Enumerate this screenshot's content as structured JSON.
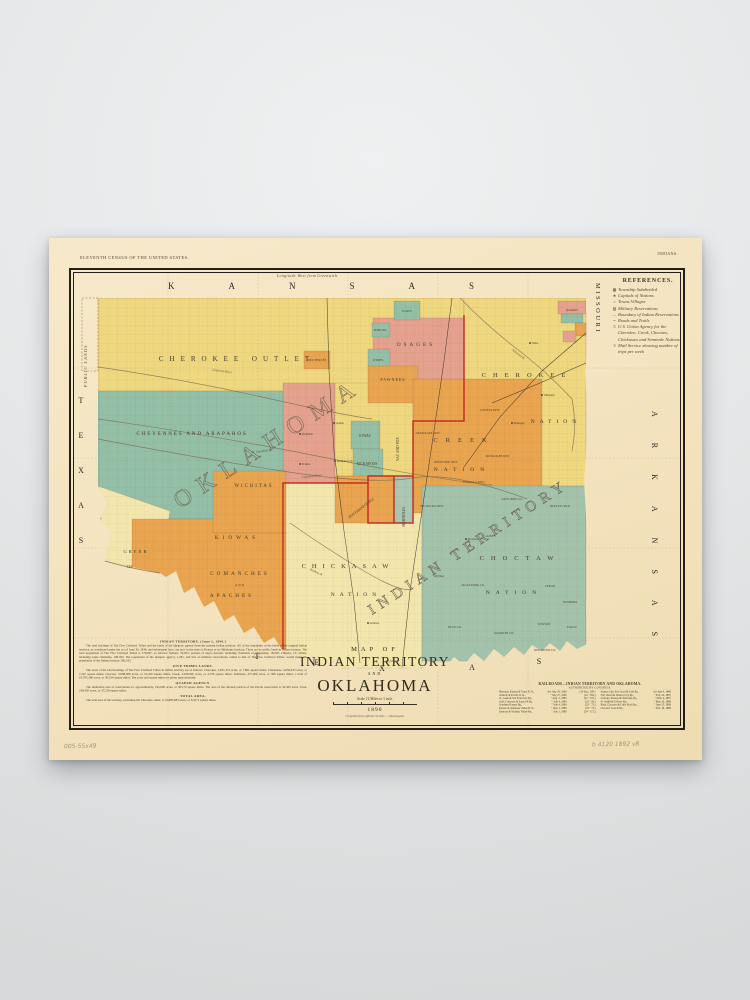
{
  "palette": {
    "paper": "#f3e2bd",
    "yellow": "#eed77f",
    "pale_yellow": "#f1e0a6",
    "pale_yellow2": "#f3e6ad",
    "orange": "#e8a44f",
    "salmon": "#e4a28e",
    "teal": "#94bfa7",
    "teal_light": "#a9c7b2",
    "green": "#a3c2ab",
    "red_line": "#c0251e",
    "ink": "#241f18"
  },
  "poster_notes": {
    "top_left": "ELEVENTH CENSUS OF THE UNITED STATES.",
    "top_right": "INDIANS.",
    "top_center": "Longitude West from Greenwich.",
    "pencil_left": "005-55x49",
    "pencil_right": "b 4120  1892  v8"
  },
  "references": {
    "title": "REFERENCES.",
    "items": [
      {
        "sym": "▦",
        "text": "Township Subdivided"
      },
      {
        "sym": "★",
        "text": "Capitals of Nations"
      },
      {
        "sym": "○",
        "text": "Towns Villages"
      },
      {
        "sym": "▨",
        "text": "Military Reservations"
      },
      {
        "sym": "—",
        "text": "Boundary of Indian Reservations"
      },
      {
        "sym": "=",
        "text": "Roads and Trails"
      },
      {
        "sym": "5",
        "text": "U.S. Union Agency for the Cherokee, Creek, Choctaw, Chickasaw and Seminole Nations"
      },
      {
        "sym": "3",
        "text": "Mail Service showing number of trips per week"
      }
    ]
  },
  "title_block": {
    "line1": "MAP OF",
    "line2": "INDIAN TERRITORY",
    "line3": "AND",
    "line4": "OKLAHOMA",
    "scale_note": "Scale 12 Miles to 1 inch.",
    "year": "1890",
    "imprint": "Compiled from official records — Washington."
  },
  "notes": {
    "sections": [
      {
        "heading": "INDIAN TERRITORY.  (June 1, 1890.)",
        "body": "The land holdings of The Five Civilized Tribes and the lands of the Quapaw agency form the present Indian territory. All of the remainder of the lands of the original Indian territory, as constituted under the act of June 30, 1834, and subsequent laws, are now in the state of Kansas or in Oklahoma territory. There are no public lands in Indian territory. The total population of The Five Civilized Tribes is 178,097, as follows: Indians, 50,055; persons of negro descent, including claimants of citizenship, 18,636; Chinese, 13; whites, including some claimants, 109,393. The population of the Quapaw agency, 1,281, and 941 on military reservations, added to that of The Five Civilized Tribes, would make the population of the Indian territory 180,182."
      },
      {
        "heading": "FIVE TRIBES LANDS.",
        "body": "The areas of the land holdings of The Five Civilized Tribes in Indian territory are as follows: Cherokee, 5,031,351 acres, or 7,861 square miles; Chickasaw, 4,650,935 acres, or 7,267 square miles; Choctaw, 6,688,000 acres, or 10,450 square miles; Creek, 3,040,000 acres, or 4,750 square miles; Seminole, 375,000 acres, or 586 square miles; a total of 19,785,286 acres, or 30,914 square miles. The acres and square miles are given approximately."
      },
      {
        "heading": "QUAPAW AGENCY.",
        "body": "The unallotted area of reservations is, approximately, 195,000 acres, or 305.70 square miles. The area of the allotted portion of the Peoria reservation is 43,450 acres. Total, 238,450 acres, or 372.58 square miles."
      },
      {
        "heading": "TOTAL AREA.",
        "body": "The total area of the territory, excluding the Cherokee outlet, is 19,885,683 acres, or 31,071 square miles."
      }
    ]
  },
  "railroads": {
    "title": "RAILROADS—INDIAN TERRITORY AND OKLAHOMA.",
    "subtitle": "AUTHORIZED BY CONGRESS.",
    "left": [
      {
        "name": "Missouri, Kansas & Texas R. R.,",
        "date": "Act July 26, 1866",
        "cite": "(14 Stat., 289.)"
      },
      {
        "name": "Atlantic & Pacific R. R.,",
        "date": "\"  July 27, 1866",
        "cite": "(14  \"  292.)"
      },
      {
        "name": "St. Louis & San Francisco Ry.,",
        "date": "\"  Aug. 2, 1882",
        "cite": "(22  \"  181.)"
      },
      {
        "name": "Gulf, Colorado & Santa Fé Ry.,",
        "date": "\"  July 4, 1884",
        "cite": "(23  \"  69.)"
      },
      {
        "name": "Southern Kansas Ry.,",
        "date": "\"  July 4, 1884",
        "cite": "(23  \"  73.)"
      },
      {
        "name": "Kansas & Arkansas Valley R. R.,",
        "date": "\"  June 1, 1886",
        "cite": "(24  \"  73.)"
      },
      {
        "name": "Denison & Washita Valley Ry.,",
        "date": "\"  July 1, 1886",
        "cite": "(24  \"  117.)"
      }
    ],
    "right": [
      {
        "name": "Kansas City, Fort Scott & Gulf Ry.,",
        "date": "Act July 4, 1888",
        "cite": "(25 Stat., 236.)"
      },
      {
        "name": "Fort Worth & Denver City Ry.,",
        "date": "\"  Feb. 24, 1887",
        "cite": "(24  \"  446.)"
      },
      {
        "name": "Chicago, Kansas & Nebraska Ry.,",
        "date": "\"  Mch. 2, 1887",
        "cite": "(24  \"  440.)"
      },
      {
        "name": "Ft. Smith & El Paso Ry.,",
        "date": "\"  May 30, 1888",
        "cite": "(25  \"  162.)"
      },
      {
        "name": "Paris, Choctaw & Little Rock Ry.,",
        "date": "\"  June 25, 1888",
        "cite": "(25  \"  205.)"
      },
      {
        "name": "Choctaw Coal & Ry.,",
        "date": "\"  Feb. 18, 1888",
        "cite": "(25  \"  35.)"
      }
    ]
  },
  "map": {
    "labels": [
      {
        "id": "kansas",
        "t": "KANSAS",
        "x": 96,
        "y": 18,
        "s": 9,
        "ls": 54,
        "a": "start",
        "c": "state"
      },
      {
        "id": "missouri",
        "t": "MISSOURI",
        "x": 0,
        "y": 0,
        "s": 6.5,
        "ls": 2.5,
        "a": "start",
        "c": "state",
        "tr": "translate(524,12) rotate(90)"
      },
      {
        "id": "arkansas",
        "t": "ARKANSAS",
        "x": 0,
        "y": 0,
        "s": 8,
        "ls": 26,
        "a": "start",
        "c": "state",
        "tr": "translate(580,140) rotate(90)"
      },
      {
        "id": "texas-w-t",
        "t": "T",
        "x": 9,
        "y": 132,
        "s": 8,
        "c": "state"
      },
      {
        "id": "texas-w-e",
        "t": "E",
        "x": 9,
        "y": 167,
        "s": 8,
        "c": "state"
      },
      {
        "id": "texas-w-x",
        "t": "X",
        "x": 9,
        "y": 202,
        "s": 8,
        "c": "state"
      },
      {
        "id": "texas-w-a",
        "t": "A",
        "x": 9,
        "y": 237,
        "s": 8,
        "c": "state"
      },
      {
        "id": "texas-w-s",
        "t": "S",
        "x": 9,
        "y": 272,
        "s": 8,
        "c": "state"
      },
      {
        "id": "texas-s-t",
        "t": "T",
        "x": 185,
        "y": 388,
        "s": 8,
        "c": "state"
      },
      {
        "id": "texas-s-e",
        "t": "E",
        "x": 245,
        "y": 394,
        "s": 8,
        "c": "state"
      },
      {
        "id": "texas-s-x",
        "t": "X",
        "x": 310,
        "y": 400,
        "s": 8,
        "c": "state"
      },
      {
        "id": "texas-s-a",
        "t": "A",
        "x": 400,
        "y": 399,
        "s": 8,
        "c": "state"
      },
      {
        "id": "texas-s-s",
        "t": "S",
        "x": 467,
        "y": 393,
        "s": 8,
        "c": "state"
      },
      {
        "id": "public-lands",
        "t": "PUBLIC  LANDS",
        "x": 0,
        "y": 0,
        "s": 4.5,
        "ls": 1,
        "c": "pl",
        "tr": "translate(15,95) rotate(-90)"
      },
      {
        "id": "oklahoma-big",
        "t": "OKLAHOMA",
        "x": 0,
        "y": 0,
        "s": 24,
        "ls": 10,
        "a": "start",
        "c": "hollow",
        "tr": "translate(108,238) rotate(-33)"
      },
      {
        "id": "indian-territory-big",
        "t": "INDIAN TERRITORY",
        "x": 0,
        "y": 0,
        "s": 15,
        "ls": 6,
        "a": "start",
        "c": "hollow",
        "tr": "translate(300,344) rotate(-33)"
      },
      {
        "id": "cherokee-outlet",
        "t": "CHEROKEE  OUTLET",
        "x": 165,
        "y": 90,
        "s": 7,
        "ls": 6,
        "c": "region"
      },
      {
        "id": "cheyennes-arapahos",
        "t": "CHEYENNES AND ARAPAHOS",
        "x": 120,
        "y": 164,
        "s": 5.2,
        "ls": 1.8,
        "c": "region"
      },
      {
        "id": "wichitas",
        "t": "WICHITAS",
        "x": 182,
        "y": 216,
        "s": 4.8,
        "ls": 2,
        "c": "region"
      },
      {
        "id": "kiowas",
        "t": "KIOWAS",
        "x": 165,
        "y": 268,
        "s": 5.2,
        "ls": 4,
        "c": "region"
      },
      {
        "id": "comanches",
        "t": "COMANCHES",
        "x": 168,
        "y": 304,
        "s": 5.2,
        "ls": 3,
        "c": "region"
      },
      {
        "id": "and",
        "t": "AND",
        "x": 168,
        "y": 315,
        "s": 3.2,
        "ls": 1,
        "c": "region"
      },
      {
        "id": "apaches",
        "t": "APACHES",
        "x": 160,
        "y": 326,
        "s": 5.2,
        "ls": 3,
        "c": "region"
      },
      {
        "id": "greer",
        "t": "GREER",
        "x": 64,
        "y": 282,
        "s": 4.6,
        "ls": 2,
        "c": "region"
      },
      {
        "id": "greer-co",
        "t": "CO.",
        "x": 58,
        "y": 297,
        "s": 4,
        "c": "region"
      },
      {
        "id": "osages",
        "t": "OSAGES",
        "x": 344,
        "y": 75,
        "s": 5.2,
        "ls": 3,
        "c": "region"
      },
      {
        "id": "pawnees",
        "t": "PAWNEES",
        "x": 321,
        "y": 110,
        "s": 4,
        "ls": 1,
        "c": "region"
      },
      {
        "id": "kaws",
        "t": "KAWS",
        "x": 335,
        "y": 41,
        "s": 3.2,
        "c": "tiny"
      },
      {
        "id": "poncas",
        "t": "PONCAS",
        "x": 308,
        "y": 60,
        "s": 3.2,
        "c": "tiny"
      },
      {
        "id": "otoes",
        "t": "OTOES",
        "x": 306,
        "y": 90,
        "s": 3.2,
        "c": "tiny"
      },
      {
        "id": "nez-perces",
        "t": "NEZ PERCÉS",
        "x": 245,
        "y": 90,
        "s": 3.2,
        "c": "tiny"
      },
      {
        "id": "iowas",
        "t": "IOWAS",
        "x": 293,
        "y": 166,
        "s": 3.6,
        "c": "tiny"
      },
      {
        "id": "kickapoos",
        "t": "KICKAPOOS",
        "x": 295,
        "y": 194,
        "s": 3.6,
        "c": "tiny"
      },
      {
        "id": "pottawatomies",
        "t": "POTTAWATOMIES",
        "x": 0,
        "y": 0,
        "s": 3.8,
        "c": "tiny",
        "tr": "translate(290,238) rotate(-38)"
      },
      {
        "id": "sac-and-fox",
        "t": "SAC AND FOX",
        "x": 0,
        "y": 0,
        "s": 3.6,
        "c": "tiny",
        "tr": "translate(327,178) rotate(-90)"
      },
      {
        "id": "seminoles",
        "t": "SEMINOLES",
        "x": 0,
        "y": 0,
        "s": 3.6,
        "c": "tiny",
        "tr": "translate(333,246) rotate(-90)"
      },
      {
        "id": "cherokee-nation-1",
        "t": "CHEROKEE",
        "x": 455,
        "y": 106,
        "s": 6.5,
        "ls": 7,
        "c": "region"
      },
      {
        "id": "cherokee-nation-2",
        "t": "NATION",
        "x": 484,
        "y": 152,
        "s": 5.5,
        "ls": 5,
        "c": "region"
      },
      {
        "id": "creek-nation-1",
        "t": "CREEK",
        "x": 392,
        "y": 171,
        "s": 6.5,
        "ls": 8,
        "c": "region"
      },
      {
        "id": "creek-nation-2",
        "t": "NATION",
        "x": 390,
        "y": 200,
        "s": 5.5,
        "ls": 6,
        "c": "region"
      },
      {
        "id": "coweta-dist",
        "t": "COWETA DIST.",
        "x": 418,
        "y": 140,
        "s": 3,
        "c": "district"
      },
      {
        "id": "okmulgee-dist",
        "t": "OKMULGEE DIST.",
        "x": 356,
        "y": 163,
        "s": 3,
        "c": "district"
      },
      {
        "id": "muskogee-dist",
        "t": "MUSKOGEE DIST.",
        "x": 426,
        "y": 186,
        "s": 3,
        "c": "district"
      },
      {
        "id": "deep-fork-dist",
        "t": "DEEP FORK DIST.",
        "x": 374,
        "y": 192,
        "s": 3,
        "c": "district"
      },
      {
        "id": "eufaula-dist",
        "t": "EUFAULA DIST.",
        "x": 402,
        "y": 212,
        "s": 3,
        "c": "district"
      },
      {
        "id": "wewoka-dist",
        "t": "WE-WO-KA DIST.",
        "x": 360,
        "y": 236,
        "s": 3,
        "c": "district"
      },
      {
        "id": "chickasaw-nation-1",
        "t": "CHICKASAW",
        "x": 276,
        "y": 297,
        "s": 6.5,
        "ls": 6,
        "c": "region"
      },
      {
        "id": "chickasaw-nation-2",
        "t": "NATION",
        "x": 284,
        "y": 325,
        "s": 5.5,
        "ls": 5,
        "c": "region"
      },
      {
        "id": "choctaw-nation-1",
        "t": "CHOCTAW",
        "x": 448,
        "y": 289,
        "s": 6.5,
        "ls": 7,
        "c": "region"
      },
      {
        "id": "choctaw-nation-2",
        "t": "NATION",
        "x": 442,
        "y": 323,
        "s": 5.5,
        "ls": 6,
        "c": "region"
      },
      {
        "id": "skullyville",
        "t": "SKULLYVILLE",
        "x": 488,
        "y": 236,
        "s": 3,
        "c": "district"
      },
      {
        "id": "sans-bois-co",
        "t": "SANS BOIS CO.",
        "x": 440,
        "y": 229,
        "s": 3,
        "c": "district"
      },
      {
        "id": "gaines",
        "t": "GAINES",
        "x": 418,
        "y": 266,
        "s": 3,
        "c": "district"
      },
      {
        "id": "atoka",
        "t": "ATOKA",
        "x": 367,
        "y": 306,
        "s": 3,
        "c": "district"
      },
      {
        "id": "jacks-fork-co",
        "t": "JACKS FORK CO.",
        "x": 401,
        "y": 315,
        "s": 3,
        "c": "district"
      },
      {
        "id": "cedar",
        "t": "CEDAR",
        "x": 478,
        "y": 316,
        "s": 3,
        "c": "district"
      },
      {
        "id": "nashoba",
        "t": "NASHOBA",
        "x": 498,
        "y": 332,
        "s": 3,
        "c": "district"
      },
      {
        "id": "kiamichi-co",
        "t": "KIAMICHI CO.",
        "x": 432,
        "y": 363,
        "s": 3,
        "c": "district"
      },
      {
        "id": "towson",
        "t": "TOWSON",
        "x": 472,
        "y": 354,
        "s": 3,
        "c": "district"
      },
      {
        "id": "eagle",
        "t": "EAGLE",
        "x": 500,
        "y": 357,
        "s": 3,
        "c": "district"
      },
      {
        "id": "red-river-co",
        "t": "RED RIVER CO.",
        "x": 473,
        "y": 380,
        "s": 3,
        "c": "district"
      },
      {
        "id": "blue-co",
        "t": "BLUE CO.",
        "x": 383,
        "y": 357,
        "s": 3,
        "c": "district"
      },
      {
        "id": "quapaws",
        "t": "QUAPAWS",
        "x": 500,
        "y": 40,
        "s": 2.6,
        "c": "tiny"
      },
      {
        "id": "red-river-lbl",
        "t": "Red River",
        "x": 0,
        "y": 0,
        "s": 3.2,
        "c": "river",
        "tr": "translate(320,391) rotate(-4)"
      },
      {
        "id": "canadian-lbl",
        "t": "Canadian River",
        "x": 0,
        "y": 0,
        "s": 3.2,
        "c": "river",
        "tr": "translate(240,206) rotate(-6)"
      },
      {
        "id": "n-canadian-lbl",
        "t": "N. Canadian R.",
        "x": 0,
        "y": 0,
        "s": 3.2,
        "c": "river",
        "tr": "translate(190,181) rotate(-8)"
      },
      {
        "id": "cimarron-lbl",
        "t": "Cimarron River",
        "x": 0,
        "y": 0,
        "s": 3.2,
        "c": "river",
        "tr": "translate(150,101) rotate(8)"
      },
      {
        "id": "arkansas-r-lbl",
        "t": "Arkansas R.",
        "x": 0,
        "y": 0,
        "s": 3.2,
        "c": "river",
        "tr": "translate(446,84) rotate(38)"
      },
      {
        "id": "washita-lbl",
        "t": "Washita R.",
        "x": 0,
        "y": 0,
        "s": 3.2,
        "c": "river",
        "tr": "translate(244,302) rotate(25)"
      }
    ],
    "towns": [
      {
        "id": "vinita",
        "t": "Vinita",
        "x": 458,
        "y": 72
      },
      {
        "id": "tahlequah",
        "t": "Tahlequah",
        "x": 470,
        "y": 124
      },
      {
        "id": "muskogee",
        "t": "Muskogee",
        "x": 440,
        "y": 152
      },
      {
        "id": "guthrie",
        "t": "Guthrie",
        "x": 262,
        "y": 152
      },
      {
        "id": "kingfisher",
        "t": "Kingfisher",
        "x": 228,
        "y": 163
      },
      {
        "id": "el-reno",
        "t": "El Reno",
        "x": 228,
        "y": 193
      },
      {
        "id": "oklahoma-city",
        "t": "Oklahoma City",
        "x": 263,
        "y": 190
      },
      {
        "id": "mcalester",
        "t": "McAlester",
        "x": 394,
        "y": 268
      },
      {
        "id": "ardmore",
        "t": "Ardmore",
        "x": 296,
        "y": 352
      }
    ]
  }
}
